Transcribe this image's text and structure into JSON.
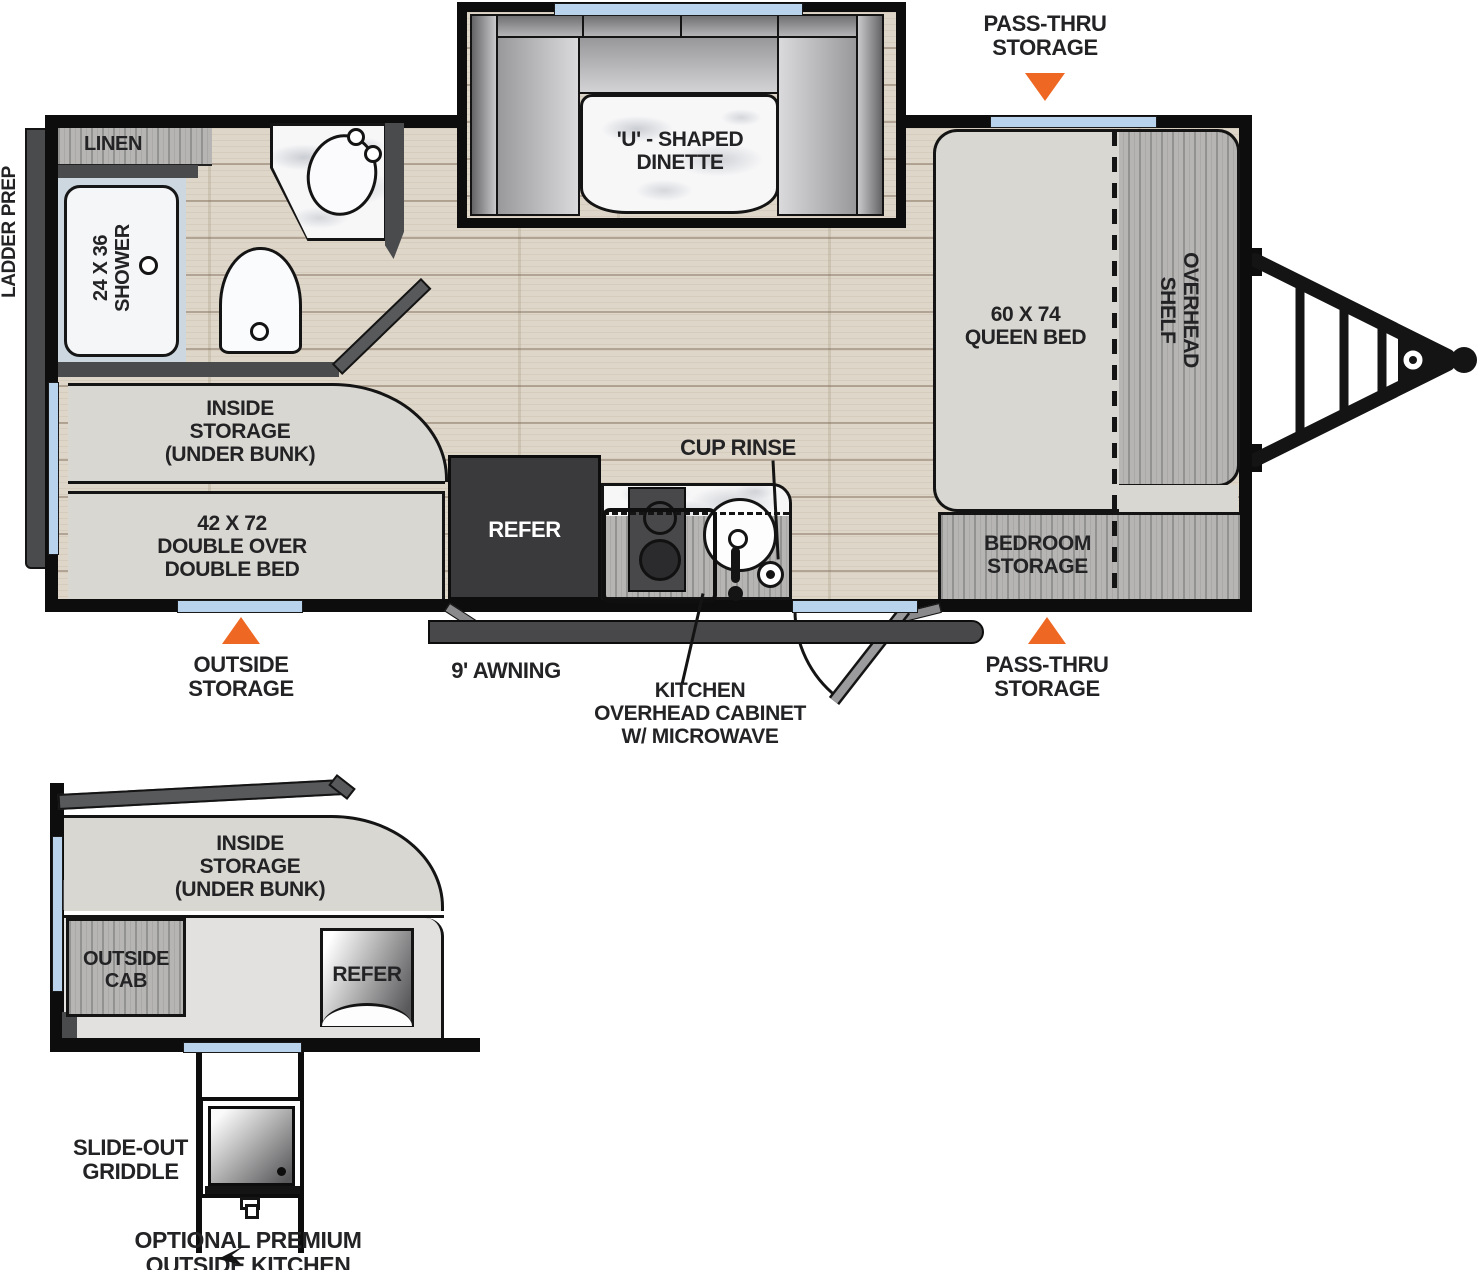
{
  "colors": {
    "orange": "#ee6823",
    "window_blue": "#b9d3ec"
  },
  "main_plan": {
    "exterior": {
      "ladder_prep": "LADDER PREP",
      "pass_thru_top": [
        "PASS-THRU",
        "STORAGE"
      ],
      "pass_thru_bottom": [
        "PASS-THRU",
        "STORAGE"
      ],
      "outside_storage": [
        "OUTSIDE",
        "STORAGE"
      ],
      "awning": "9' AWNING"
    },
    "rooms": {
      "linen": "LINEN",
      "shower": [
        "24 X 36",
        "SHOWER"
      ],
      "dinette": [
        "'U' - SHAPED",
        "DINETTE"
      ],
      "queen_bed": [
        "60 X 74",
        "QUEEN BED"
      ],
      "overhead_shelf": [
        "OVERHEAD",
        "SHELF"
      ],
      "inside_storage": [
        "INSIDE",
        "STORAGE",
        "(UNDER BUNK)"
      ],
      "double_bed": [
        "42 X 72",
        "DOUBLE OVER",
        "DOUBLE BED"
      ],
      "refer": "REFER",
      "cup_rinse": "CUP RINSE",
      "kitchen_cabinet": [
        "KITCHEN",
        "OVERHEAD CABINET",
        "W/ MICROWAVE"
      ],
      "bedroom_storage": [
        "BEDROOM",
        "STORAGE"
      ]
    }
  },
  "outside_kitchen_plan": {
    "inside_storage": [
      "INSIDE",
      "STORAGE",
      "(UNDER BUNK)"
    ],
    "outside_cab": [
      "OUTSIDE",
      "CAB"
    ],
    "refer": "REFER",
    "slide_out_griddle": [
      "SLIDE-OUT",
      "GRIDDLE"
    ],
    "caption": [
      "OPTIONAL PREMIUM",
      "OUTSIDE KITCHEN"
    ]
  }
}
